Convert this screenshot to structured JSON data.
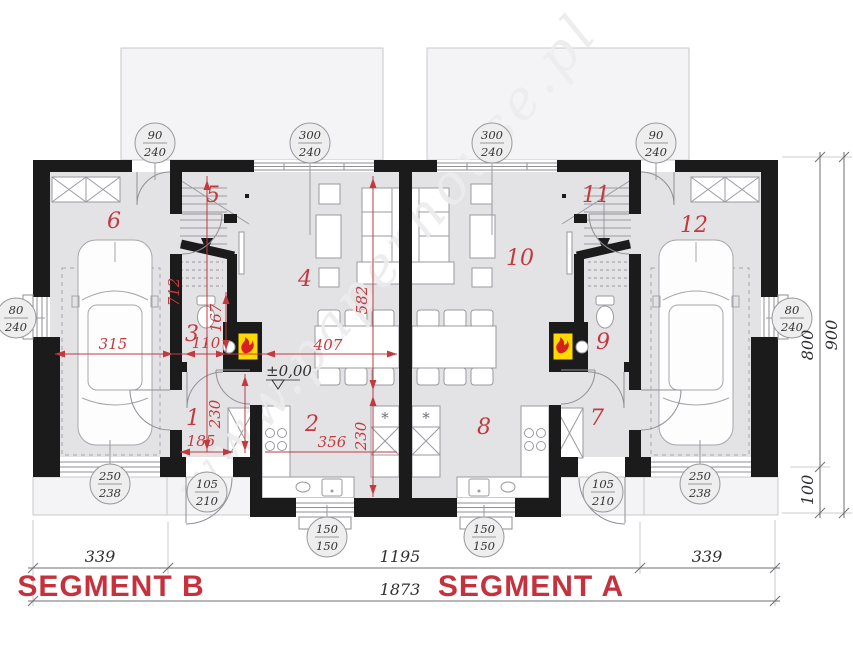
{
  "watermark": {
    "text": "www.paperhouse.pl"
  },
  "rooms": {
    "r1": "1",
    "r2": "2",
    "r3": "3",
    "r4": "4",
    "r5": "5",
    "r6": "6",
    "r7": "7",
    "r8": "8",
    "r9": "9",
    "r10": "10",
    "r11": "11",
    "r12": "12"
  },
  "red_dims": {
    "v712": "712",
    "h315": "315",
    "v167": "167",
    "h110": "110",
    "h185": "185",
    "v230_hall": "230",
    "v582": "582",
    "h407": "407",
    "h356": "356",
    "v230_kitchen": "230",
    "level": "±0,00"
  },
  "size_circles": [
    {
      "top": "90",
      "bottom": "240"
    },
    {
      "top": "300",
      "bottom": "240"
    },
    {
      "top": "300",
      "bottom": "240"
    },
    {
      "top": "90",
      "bottom": "240"
    },
    {
      "top": "80",
      "bottom": "240"
    },
    {
      "top": "80",
      "bottom": "240"
    },
    {
      "top": "250",
      "bottom": "238"
    },
    {
      "top": "250",
      "bottom": "238"
    },
    {
      "top": "105",
      "bottom": "210"
    },
    {
      "top": "105",
      "bottom": "210"
    },
    {
      "top": "150",
      "bottom": "150"
    },
    {
      "top": "150",
      "bottom": "150"
    }
  ],
  "bottom_dims": {
    "seg_b_width": "339",
    "center_width": "1195",
    "seg_a_width": "339",
    "total_width": "1873",
    "segment_b_label": "SEGMENT B",
    "segment_a_label": "SEGMENT A"
  },
  "side_dims": {
    "depth_main": "800",
    "depth_front": "100",
    "depth_total": "900"
  },
  "kitchen": {
    "tall_unit_symbol": "*"
  },
  "colors": {
    "wall": "#1b1b1b",
    "floor": "#e3e3e6",
    "terrace": "#f4f4f6",
    "annotation_red": "#c23a3e",
    "fireplace_yellow": "#ffd900",
    "flame_red": "#d81f1f"
  }
}
